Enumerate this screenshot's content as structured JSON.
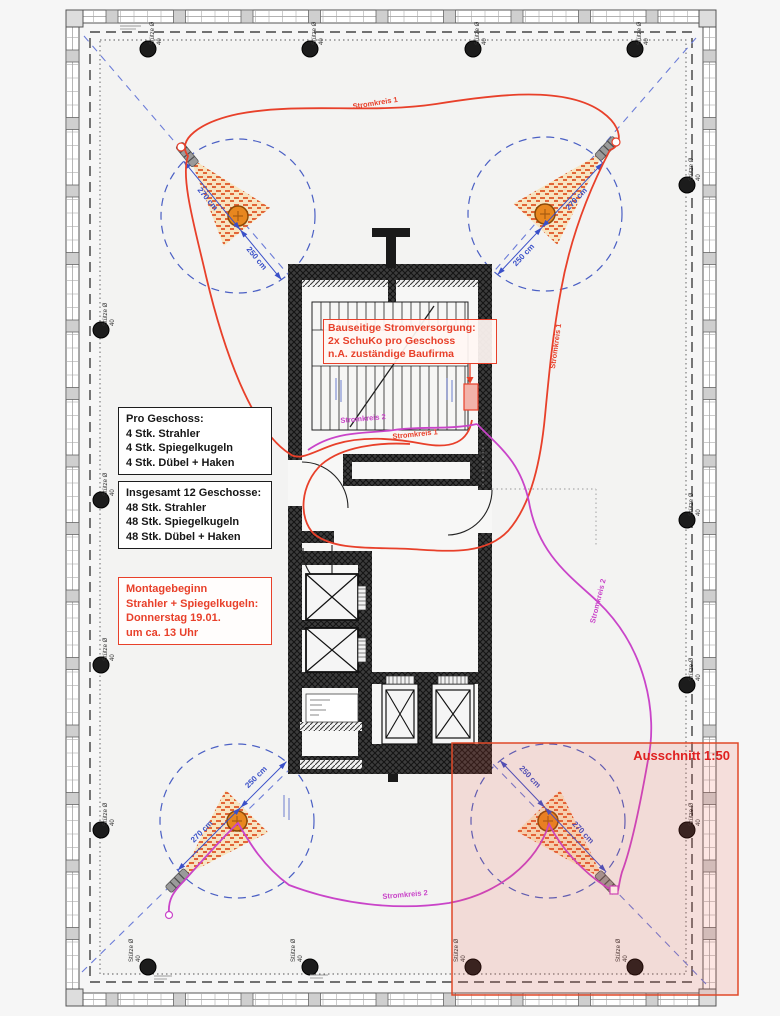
{
  "annotations": {
    "power_note": {
      "lines": [
        "Bauseitige Stromversorgung:",
        "2x SchuKo pro Geschoss",
        "n.A. zuständige Baufirma"
      ]
    },
    "per_floor": {
      "title": "Pro Geschoss:",
      "items": [
        "4 Stk. Strahler",
        "4 Stk. Spiegelkugeln",
        "4 Stk. Dübel + Haken"
      ]
    },
    "total": {
      "title": "Insgesamt 12 Geschosse:",
      "items": [
        "48 Stk. Strahler",
        "48 Stk. Spiegelkugeln",
        "48 Stk. Dübel + Haken"
      ]
    },
    "montage": {
      "lines": [
        "Montagebeginn",
        "Strahler + Spiegelkugeln:",
        "Donnerstag 19.01.",
        "um ca. 13 Uhr"
      ]
    },
    "detail_view": {
      "label": "Ausschnitt 1:50"
    }
  },
  "labels": {
    "circuit1": "Stromkreis 1",
    "circuit2": "Stromkreis 2",
    "column_line1": "Stütze Ø",
    "column_line2": "40",
    "dim_beam": "270 cm",
    "dim_radius": "250 cm"
  },
  "colors": {
    "circuit1": "#e8402a",
    "circuit2": "#c944c9",
    "dimension_blue": "#3a50c8",
    "annotation_red": "#e8402a",
    "mirror_ball_orange": "#e8871f",
    "detail_overlay": "#e85038"
  }
}
